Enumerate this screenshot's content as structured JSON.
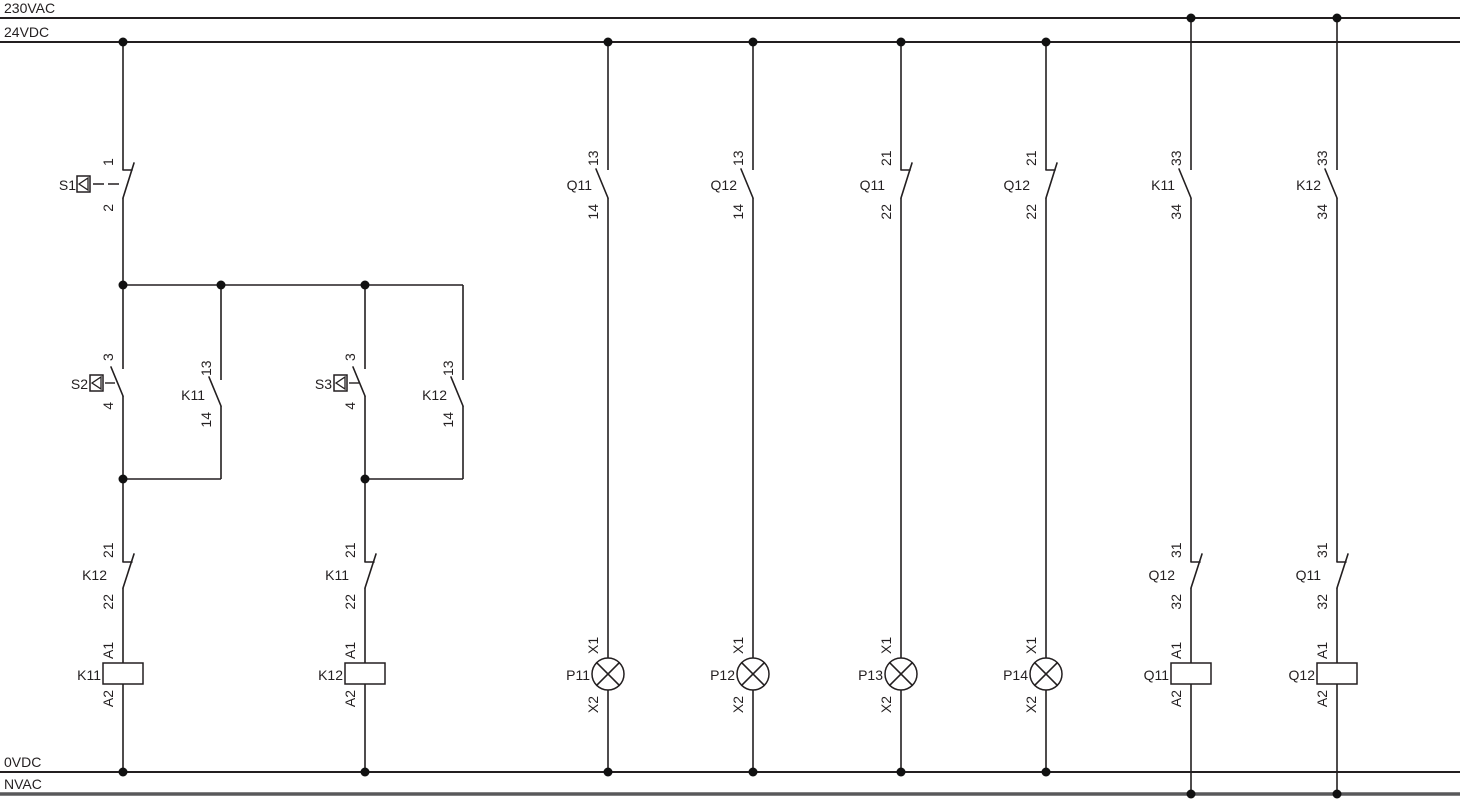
{
  "diagram_type": "ladder-control-circuit-schematic",
  "rails": {
    "top_outer": "230VAC",
    "top_inner": "24VDC",
    "bottom_inner": "0VDC",
    "bottom_outer": "NVAC"
  },
  "colors": {
    "line": "#231f20",
    "nvac_rail": "#58585a",
    "junction_dot": "#111111",
    "background": "#ffffff"
  },
  "components": {
    "s1": {
      "label": "S1",
      "top": "1",
      "bottom": "2",
      "type": "pushbutton-nc"
    },
    "s2": {
      "label": "S2",
      "top": "3",
      "bottom": "4",
      "type": "pushbutton-no"
    },
    "s3": {
      "label": "S3",
      "top": "3",
      "bottom": "4",
      "type": "pushbutton-no"
    },
    "k11_no_seal": {
      "label": "K11",
      "top": "13",
      "bottom": "14",
      "type": "contact-no"
    },
    "k12_no_seal": {
      "label": "K12",
      "top": "13",
      "bottom": "14",
      "type": "contact-no"
    },
    "k12_nc": {
      "label": "K12",
      "top": "21",
      "bottom": "22",
      "type": "contact-nc"
    },
    "k11_nc": {
      "label": "K11",
      "top": "21",
      "bottom": "22",
      "type": "contact-nc"
    },
    "k11_coil": {
      "label": "K11",
      "top": "A1",
      "bottom": "A2",
      "type": "coil"
    },
    "k12_coil": {
      "label": "K12",
      "top": "A1",
      "bottom": "A2",
      "type": "coil"
    },
    "q11_no_13": {
      "label": "Q11",
      "top": "13",
      "bottom": "14",
      "type": "contact-no"
    },
    "q12_no_13": {
      "label": "Q12",
      "top": "13",
      "bottom": "14",
      "type": "contact-no"
    },
    "q11_nc_21": {
      "label": "Q11",
      "top": "21",
      "bottom": "22",
      "type": "contact-nc"
    },
    "q12_nc_21": {
      "label": "Q12",
      "top": "21",
      "bottom": "22",
      "type": "contact-nc"
    },
    "p11": {
      "label": "P11",
      "top": "X1",
      "bottom": "X2",
      "type": "lamp"
    },
    "p12": {
      "label": "P12",
      "top": "X1",
      "bottom": "X2",
      "type": "lamp"
    },
    "p13": {
      "label": "P13",
      "top": "X1",
      "bottom": "X2",
      "type": "lamp"
    },
    "p14": {
      "label": "P14",
      "top": "X1",
      "bottom": "X2",
      "type": "lamp"
    },
    "k11_no_33": {
      "label": "K11",
      "top": "33",
      "bottom": "34",
      "type": "contact-no"
    },
    "k12_no_33": {
      "label": "K12",
      "top": "33",
      "bottom": "34",
      "type": "contact-no"
    },
    "q12_nc_31": {
      "label": "Q12",
      "top": "31",
      "bottom": "32",
      "type": "contact-nc"
    },
    "q11_nc_31": {
      "label": "Q11",
      "top": "31",
      "bottom": "32",
      "type": "contact-nc"
    },
    "q11_coil": {
      "label": "Q11",
      "top": "A1",
      "bottom": "A2",
      "type": "coil"
    },
    "q12_coil": {
      "label": "Q12",
      "top": "A1",
      "bottom": "A2",
      "type": "coil"
    }
  }
}
